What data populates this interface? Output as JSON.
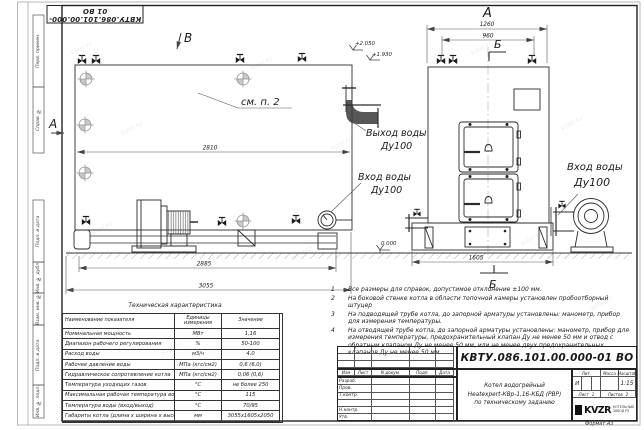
{
  "stamp": {
    "top": "КВТУ.086.101.00.000-01 ВО"
  },
  "watermark": {
    "text": "kotel.kz"
  },
  "frame": {
    "labels": {
      "perv": "Перв. примен.",
      "sprav": "Справ. №",
      "podp1": "Подп. и дата",
      "inv_dubl": "Инв. № дубл.",
      "vzam": "Взам. инв. №",
      "podp2": "Подп. и дата",
      "inv_podl": "Инв. № подл."
    }
  },
  "views": {
    "side": {
      "label_v": "В",
      "label_a": "А",
      "see_note": "см. п. 2",
      "dim_inner": "2810",
      "dim_base": "2885",
      "dim_total": "3055",
      "elev_top": "+2.050",
      "elev_mid": "+1.930",
      "elev_zero": "0.000",
      "outlet_line1": "Выход воды",
      "outlet_line2": "Ду100",
      "inlet_line1": "Вход воды",
      "inlet_line2": "Ду100"
    },
    "front": {
      "label_a": "А",
      "label_b_top": "Б",
      "label_b_bottom": "Б",
      "dim_outer": "1260",
      "dim_inner": "960",
      "dim_base": "1605",
      "inlet_line1": "Вход воды",
      "inlet_line2": "Ду100"
    }
  },
  "table": {
    "title": "Техническая характеристика",
    "headers": [
      "Наименование показателя",
      "Единицы измерения",
      "Значение"
    ],
    "rows": [
      [
        "Номинальная мощность",
        "МВт",
        "1,16"
      ],
      [
        "Диапазон рабочего регулирования",
        "%",
        "50-100"
      ],
      [
        "Расход воды",
        "м3/ч",
        "4,0"
      ],
      [
        "Рабочее давление воды",
        "МПа (кгс/см2)",
        "0,6 (6,0)"
      ],
      [
        "Гидравлическое сопротивление котла",
        "МПа (кгс/см2)",
        "0,06 (0,6)"
      ],
      [
        "Температура уходящих газов",
        "°С",
        "не более 250"
      ],
      [
        "Максимальная рабочая температура воды",
        "°С",
        "115"
      ],
      [
        "Температура воды (вход/выход)",
        "°С",
        "70/95"
      ],
      [
        "Габариты котла (длина х ширина х высота)",
        "мм",
        "3055х1605х2050"
      ]
    ]
  },
  "notes": {
    "items": [
      {
        "num": "1",
        "text": "Все размеры для справок, допустимое отклонение ±100 мм."
      },
      {
        "num": "2",
        "text": "На боковой стенке котла в области топочной камеры установлен пробоотборный штуцер"
      },
      {
        "num": "3",
        "text": "На подводящей трубе котла, до запорной арматуры установлены: манометр, прибор для измерения температуры."
      },
      {
        "num": "4",
        "text": "На отводящей трубе котла, до запорной арматуры установлены: манометр, прибор для измерения температуры, предохранительный клапан Ду не менее 50 мм и отвод с обратным клапаном Ду не менее 50 мм, или не менее двух предохранительных клапанов Ду не менее 50 мм."
      }
    ]
  },
  "tb": {
    "doc_number": "КВТУ.086.101.00.000-01 ВО",
    "cols": [
      "Изм",
      "Лист",
      "N докум.",
      "Подп.",
      "Дата"
    ],
    "rows": [
      "Разраб.",
      "Пров.",
      "Т.контр.",
      "Н.контр.",
      "Утв."
    ],
    "name1": "Котел водогрейный",
    "name2": "Heatexpert-КВр-1,16-КБД (РВР)",
    "name3": "по техническому заданию",
    "lit_h": "Лит.",
    "mass_h": "Масса",
    "scale_h": "Масштаб",
    "lit": "И",
    "scale": "1:15",
    "sheet_h": "Лист",
    "sheet": "1",
    "sheets_h": "Листов",
    "sheets": "2",
    "logo": "KVZR",
    "logo_s1": "КОТЕЛЬНЫЙ",
    "logo_s2": "ЗАВОД РУ",
    "format": "Формат А3"
  }
}
